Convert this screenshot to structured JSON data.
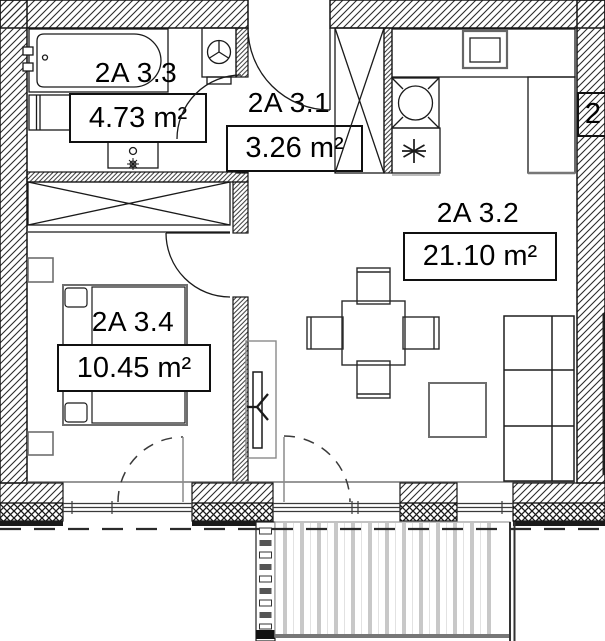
{
  "plan": {
    "rooms": [
      {
        "name": "2A 3.3",
        "area": "4.73 m²"
      },
      {
        "name": "2A 3.1",
        "area": "3.26 m²"
      },
      {
        "name": "2A 3.2",
        "area": "21.10 m²"
      },
      {
        "name": "2A 3.4",
        "area": "10.45 m²"
      }
    ],
    "neighbor_unit_label": "2",
    "colors": {
      "line": "#1a1a1a",
      "hatch": "#2b2b2b",
      "deck_stripe": "#c8c8c8",
      "background": "#ffffff"
    }
  }
}
